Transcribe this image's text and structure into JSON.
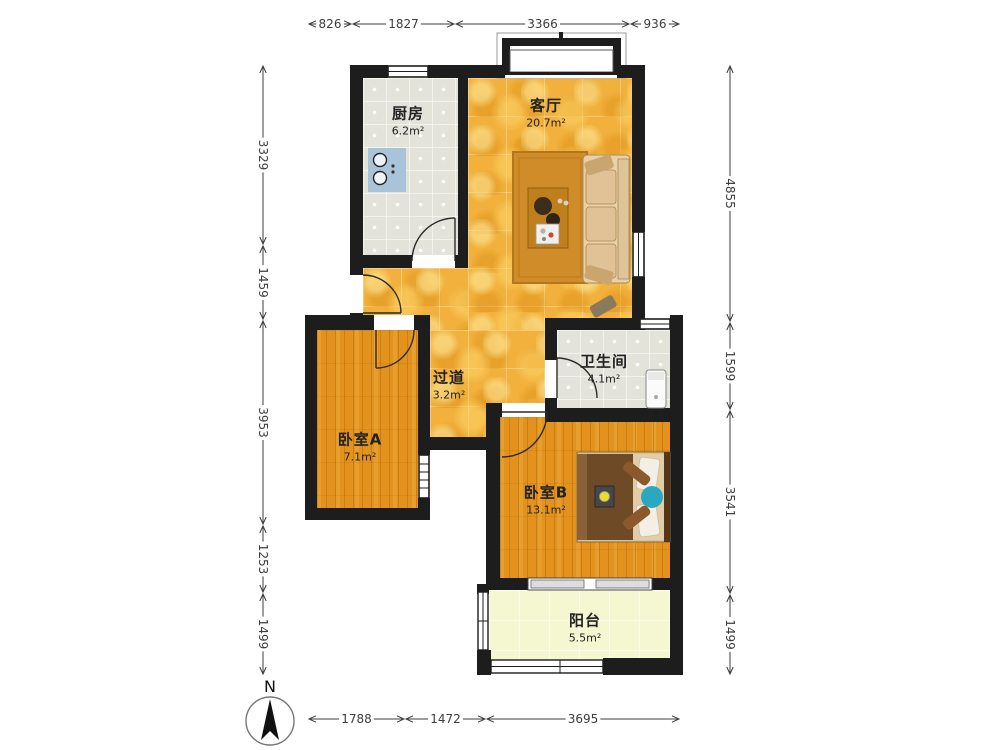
{
  "floor_plan": {
    "compass": {
      "label": "N"
    },
    "rooms": {
      "kitchen": {
        "name": "厨房",
        "area": "6.2m²"
      },
      "living_room": {
        "name": "客厅",
        "area": "20.7m²"
      },
      "hallway": {
        "name": "过道",
        "area": "3.2m²"
      },
      "bathroom": {
        "name": "卫生间",
        "area": "4.1m²"
      },
      "bedroom_a": {
        "name": "卧室A",
        "area": "7.1m²"
      },
      "bedroom_b": {
        "name": "卧室B",
        "area": "13.1m²"
      },
      "balcony": {
        "name": "阳台",
        "area": "5.5m²"
      }
    },
    "dimensions_mm": {
      "top": [
        "826",
        "1827",
        "3366",
        "936"
      ],
      "bottom": [
        "1788",
        "1472",
        "3695"
      ],
      "left": [
        "3329",
        "1459",
        "3953",
        "1253",
        "1499"
      ],
      "right": [
        "4855",
        "1599",
        "3541",
        "1499"
      ]
    },
    "colors": {
      "wall": "#1d1d1d",
      "gold_floor": "#f1b13c",
      "wood_floor": "#e2921d",
      "tile_floor": "#e3e3d9",
      "balcony_floor": "#f4f7d0",
      "dimension_text": "#3d3d3d"
    }
  }
}
